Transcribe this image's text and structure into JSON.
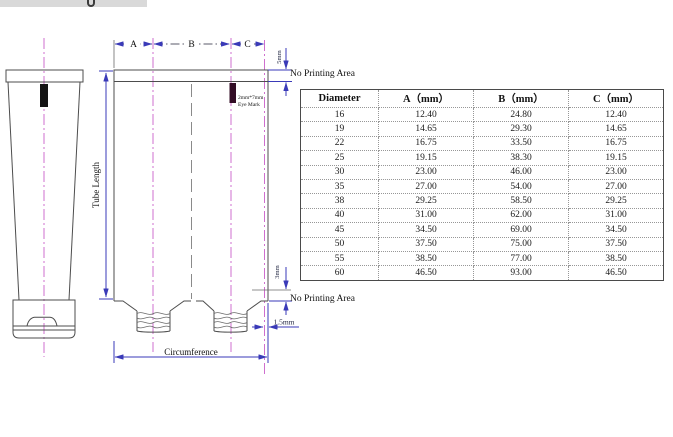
{
  "diagram": {
    "section_labels": {
      "a": "A",
      "b": "B",
      "c": "C"
    },
    "annotations": {
      "top_offset": "5mm",
      "no_printing_top": "No Printing Area",
      "eye_mark_size": "2mm*7mm",
      "eye_mark_name": "Eye Mark",
      "tube_length": "Tube Length",
      "bottom_offset": "3mm",
      "no_printing_bottom": "No Printing Area",
      "seam_offset": "1.5mm",
      "circumference": "Circumference"
    },
    "colors": {
      "centerline": "#cf6fcf",
      "dimension": "#3a3ab8",
      "outline": "#4d4d4d"
    }
  },
  "table": {
    "columns": [
      "Diameter",
      "A（mm）",
      "B（mm）",
      "C（mm）"
    ],
    "rows": [
      [
        "16",
        "12.40",
        "24.80",
        "12.40"
      ],
      [
        "19",
        "14.65",
        "29.30",
        "14.65"
      ],
      [
        "22",
        "16.75",
        "33.50",
        "16.75"
      ],
      [
        "25",
        "19.15",
        "38.30",
        "19.15"
      ],
      [
        "30",
        "23.00",
        "46.00",
        "23.00"
      ],
      [
        "35",
        "27.00",
        "54.00",
        "27.00"
      ],
      [
        "38",
        "29.25",
        "58.50",
        "29.25"
      ],
      [
        "40",
        "31.00",
        "62.00",
        "31.00"
      ],
      [
        "45",
        "34.50",
        "69.00",
        "34.50"
      ],
      [
        "50",
        "37.50",
        "75.00",
        "37.50"
      ],
      [
        "55",
        "38.50",
        "77.00",
        "38.50"
      ],
      [
        "60",
        "46.50",
        "93.00",
        "46.50"
      ]
    ]
  }
}
